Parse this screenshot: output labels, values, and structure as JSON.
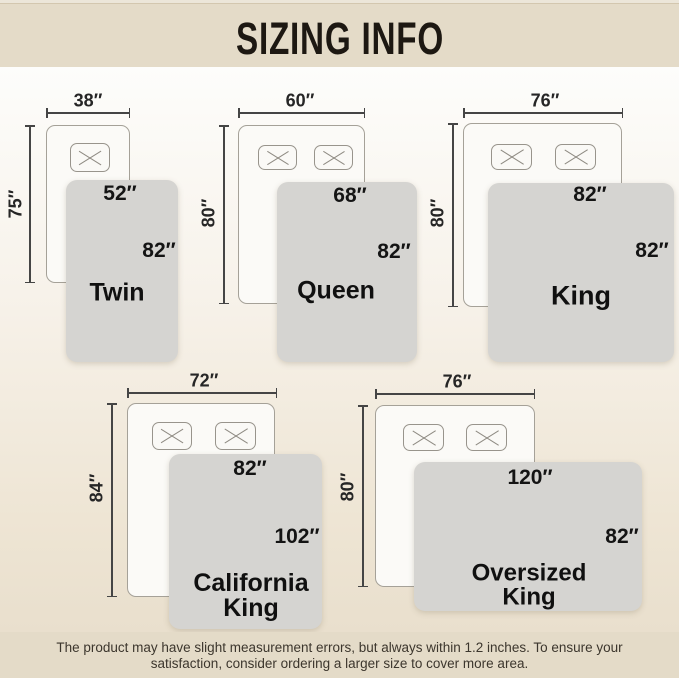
{
  "header": {
    "title": "SIZING INFO"
  },
  "diagrams": [
    {
      "name_lines": [
        "Twin"
      ],
      "bed_width": "38″",
      "bed_length": "75″",
      "blanket_width": "52″",
      "blanket_length": "82″",
      "pillows": 1
    },
    {
      "name_lines": [
        "Queen"
      ],
      "bed_width": "60″",
      "bed_length": "80″",
      "blanket_width": "68″",
      "blanket_length": "82″",
      "pillows": 2
    },
    {
      "name_lines": [
        "King"
      ],
      "bed_width": "76″",
      "bed_length": "80″",
      "blanket_width": "82″",
      "blanket_length": "82″",
      "pillows": 2
    },
    {
      "name_lines": [
        "California",
        "King"
      ],
      "bed_width": "72″",
      "bed_length": "84″",
      "blanket_width": "82″",
      "blanket_length": "102″",
      "pillows": 2
    },
    {
      "name_lines": [
        "Oversized",
        "King"
      ],
      "bed_width": "76″",
      "bed_length": "80″",
      "blanket_width": "120″",
      "blanket_length": "82″",
      "pillows": 2
    }
  ],
  "footer": {
    "line1": "The product may have slight measurement errors, but always within 1.2 inches. To ensure your",
    "line2": "satisfaction, consider ordering a larger size to cover more area."
  },
  "colors": {
    "header_bg": "#e4dbc8",
    "footer_bg": "#e4dbc8",
    "blanket": "#d5d4d1",
    "bed_fill": "#fbfaf7",
    "line": "#454545",
    "text": "#1d1812"
  }
}
